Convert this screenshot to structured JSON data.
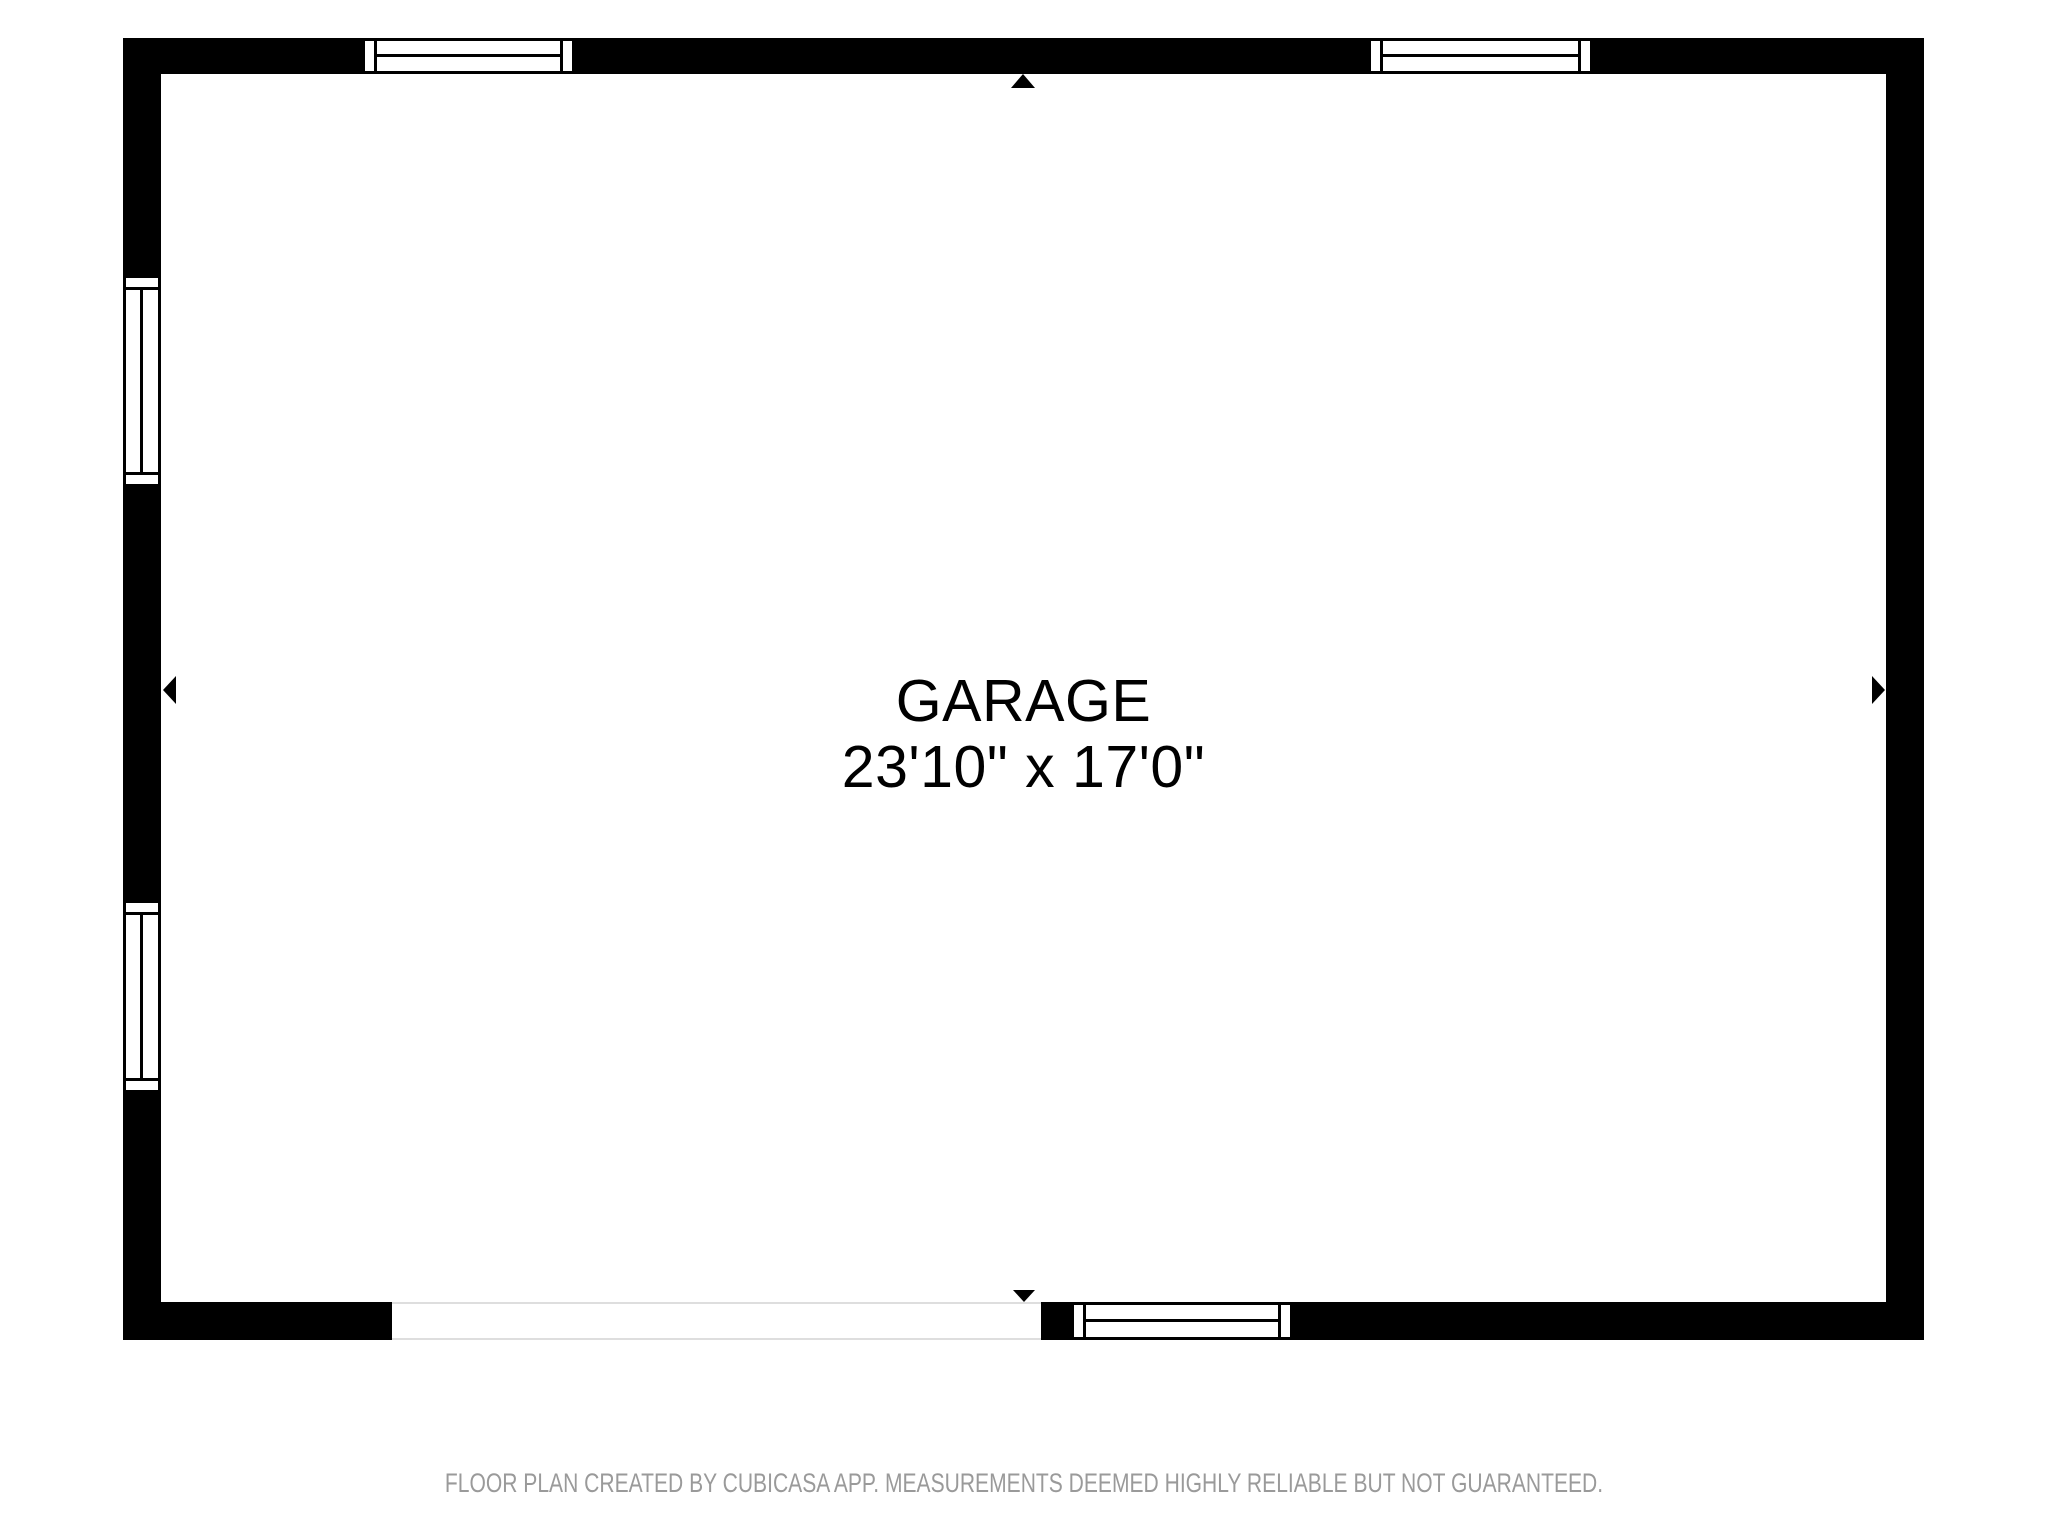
{
  "room": {
    "name": "GARAGE",
    "dimensions": "23'10\" x 17'0\""
  },
  "footer": {
    "disclaimer": "FLOOR PLAN CREATED BY CUBICASA APP. MEASUREMENTS DEEMED HIGHLY RELIABLE BUT NOT GUARANTEED."
  },
  "colors": {
    "wall": "#000000",
    "background": "#ffffff",
    "window_line": "#000000",
    "door_line": "#dedede",
    "footer_text": "#9a9a9a",
    "room_text": "#000000"
  },
  "floorplan": {
    "walls": [
      "top",
      "right",
      "bottom",
      "left"
    ],
    "windows": [
      {
        "id": "window-top-left",
        "wall": "top"
      },
      {
        "id": "window-top-right",
        "wall": "top"
      },
      {
        "id": "window-left-upper",
        "wall": "left"
      },
      {
        "id": "window-left-lower",
        "wall": "left"
      },
      {
        "id": "window-bottom",
        "wall": "bottom"
      }
    ],
    "openings": [
      {
        "id": "garage-door-opening",
        "wall": "bottom"
      }
    ],
    "markers": [
      {
        "id": "marker-top",
        "direction": "up"
      },
      {
        "id": "marker-right",
        "direction": "right"
      },
      {
        "id": "marker-bottom",
        "direction": "down"
      },
      {
        "id": "marker-left",
        "direction": "left"
      }
    ]
  }
}
